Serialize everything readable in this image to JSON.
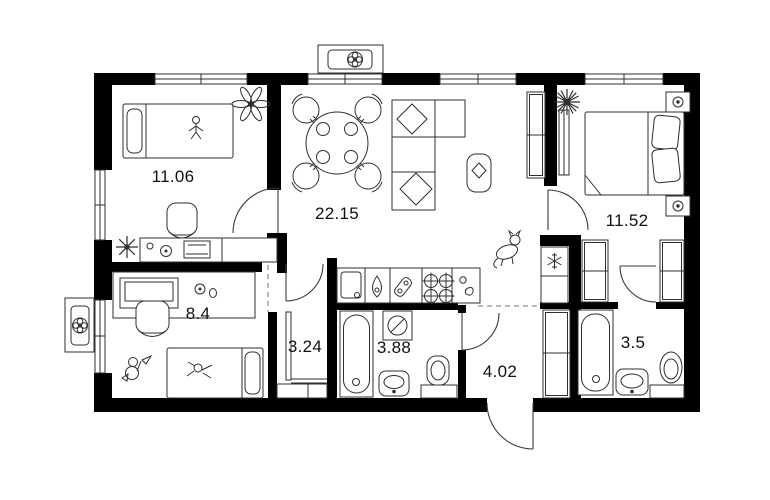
{
  "plan": {
    "background": "#ffffff",
    "wall_color": "#000000",
    "line_color": "#2f2f2f",
    "text_color": "#111111",
    "rooms": [
      {
        "name": "bedroom-1",
        "area": "11.06"
      },
      {
        "name": "living-kitchen",
        "area": "22.15"
      },
      {
        "name": "bedroom-2",
        "area": "11.52"
      },
      {
        "name": "kids-room",
        "area": "8.4"
      },
      {
        "name": "wardrobe-niche",
        "area": "3.24"
      },
      {
        "name": "bathroom",
        "area": "3.88"
      },
      {
        "name": "hallway",
        "area": "4.02"
      },
      {
        "name": "toilet-bathroom",
        "area": "3.5"
      }
    ],
    "icons": [
      "fan-icon",
      "ceiling-light-icon",
      "snowflake-icon",
      "plant-icon",
      "cat-icon",
      "toy-figure-icon",
      "doll-icon"
    ]
  }
}
